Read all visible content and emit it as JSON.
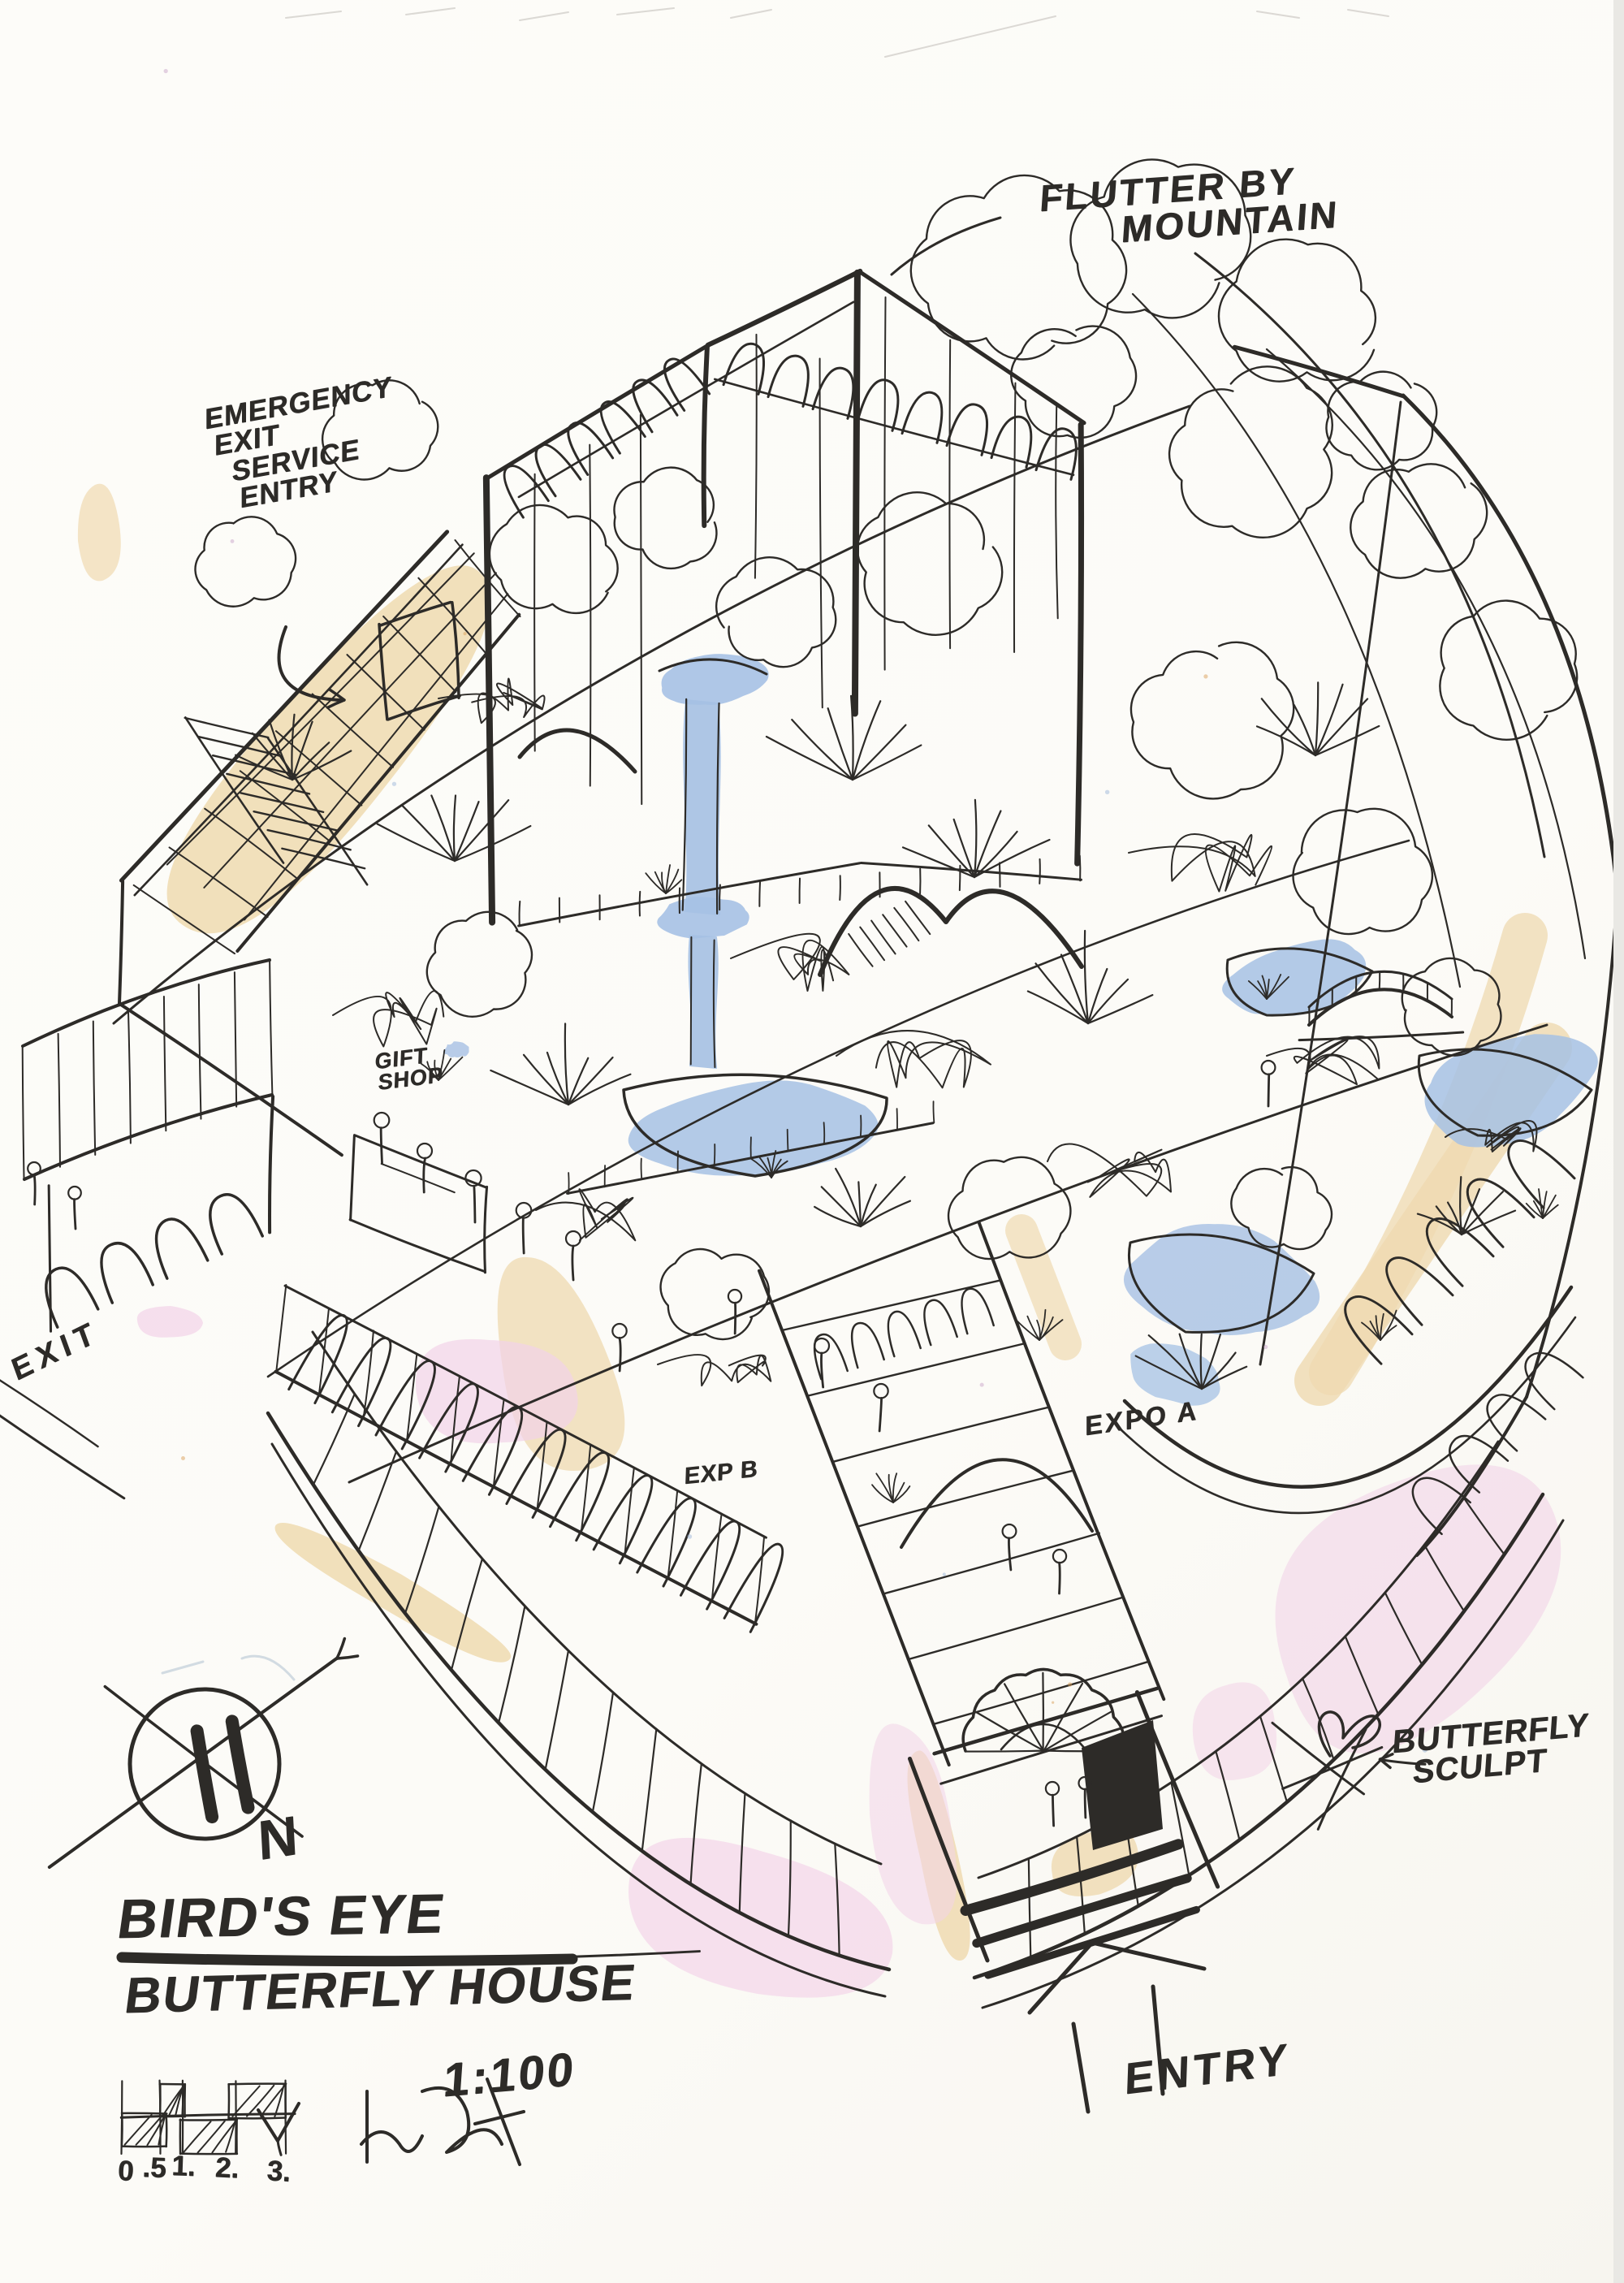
{
  "title_block": {
    "line1": "BIRD'S EYE",
    "line2": "BUTTERFLY HOUSE",
    "scale": "1:100"
  },
  "annotations": {
    "flutter_by": {
      "line1": "FLUTTER BY",
      "line2": "MOUNTAIN"
    },
    "emergency": {
      "line1": "EMERGENCY",
      "line2": "EXIT",
      "line3": "SERVICE",
      "line4": "ENTRY"
    },
    "exit_label": "EXIT",
    "gift_shop": {
      "line1": "GIFT",
      "line2": "SHOP"
    },
    "expo_b": "EXP B",
    "expo_a": "EXPO A",
    "butterfly_sculpt": {
      "line1": "BUTTERFLY",
      "line2": "SCULPT"
    },
    "entry_label": "ENTRY",
    "north_label": "N"
  },
  "scale_bar": {
    "labels": [
      "0",
      ".5",
      "1.",
      "2.",
      "3."
    ]
  },
  "colors": {
    "ink": "#2d2b28",
    "tan": "#efdab0",
    "pink": "#f2d3e8",
    "water": "#a6c1e4",
    "paper": "#fcfbf7",
    "pencil": "#b9b6b0"
  }
}
